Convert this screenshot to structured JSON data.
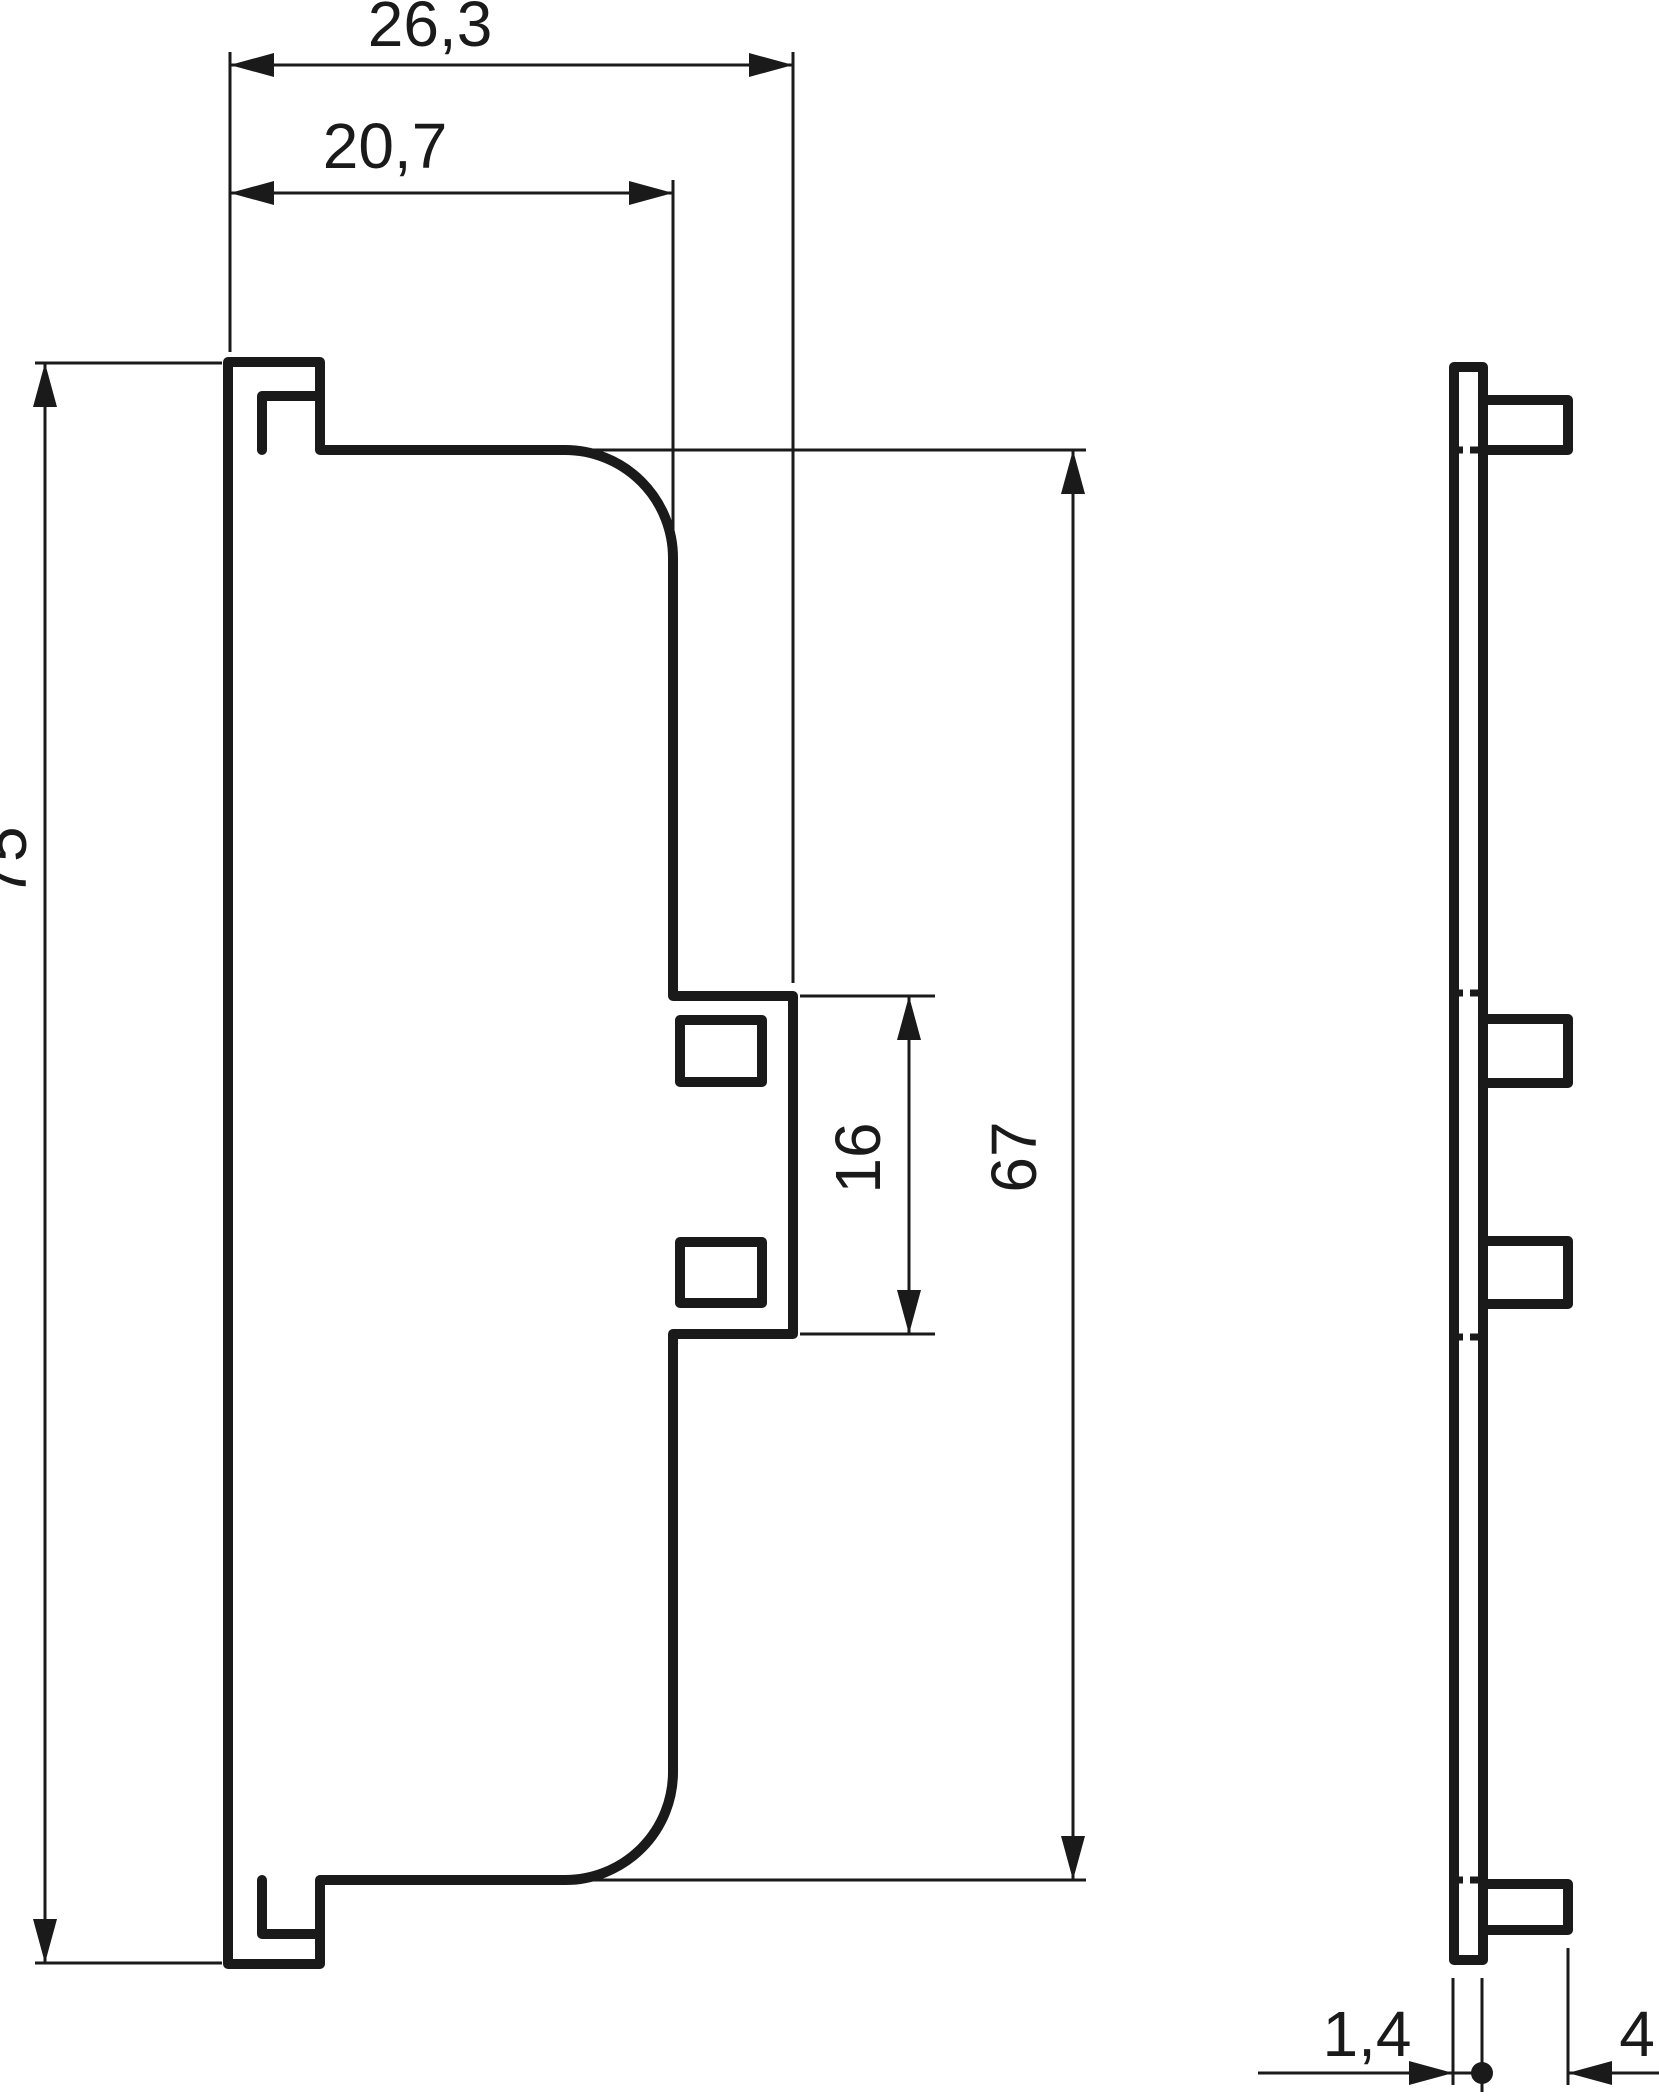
{
  "drawing": {
    "type": "technical-dimension-drawing",
    "views": [
      "front-profile",
      "side-section"
    ],
    "dimensions": {
      "overall_width": "26,3",
      "inner_width": "20,7",
      "overall_height": "75",
      "notch_height": "16",
      "body_height": "67",
      "plate_thickness": "1,4",
      "tab_depth": "4"
    },
    "colors": {
      "line": "#1a1a1a",
      "background": "#ffffff"
    }
  }
}
